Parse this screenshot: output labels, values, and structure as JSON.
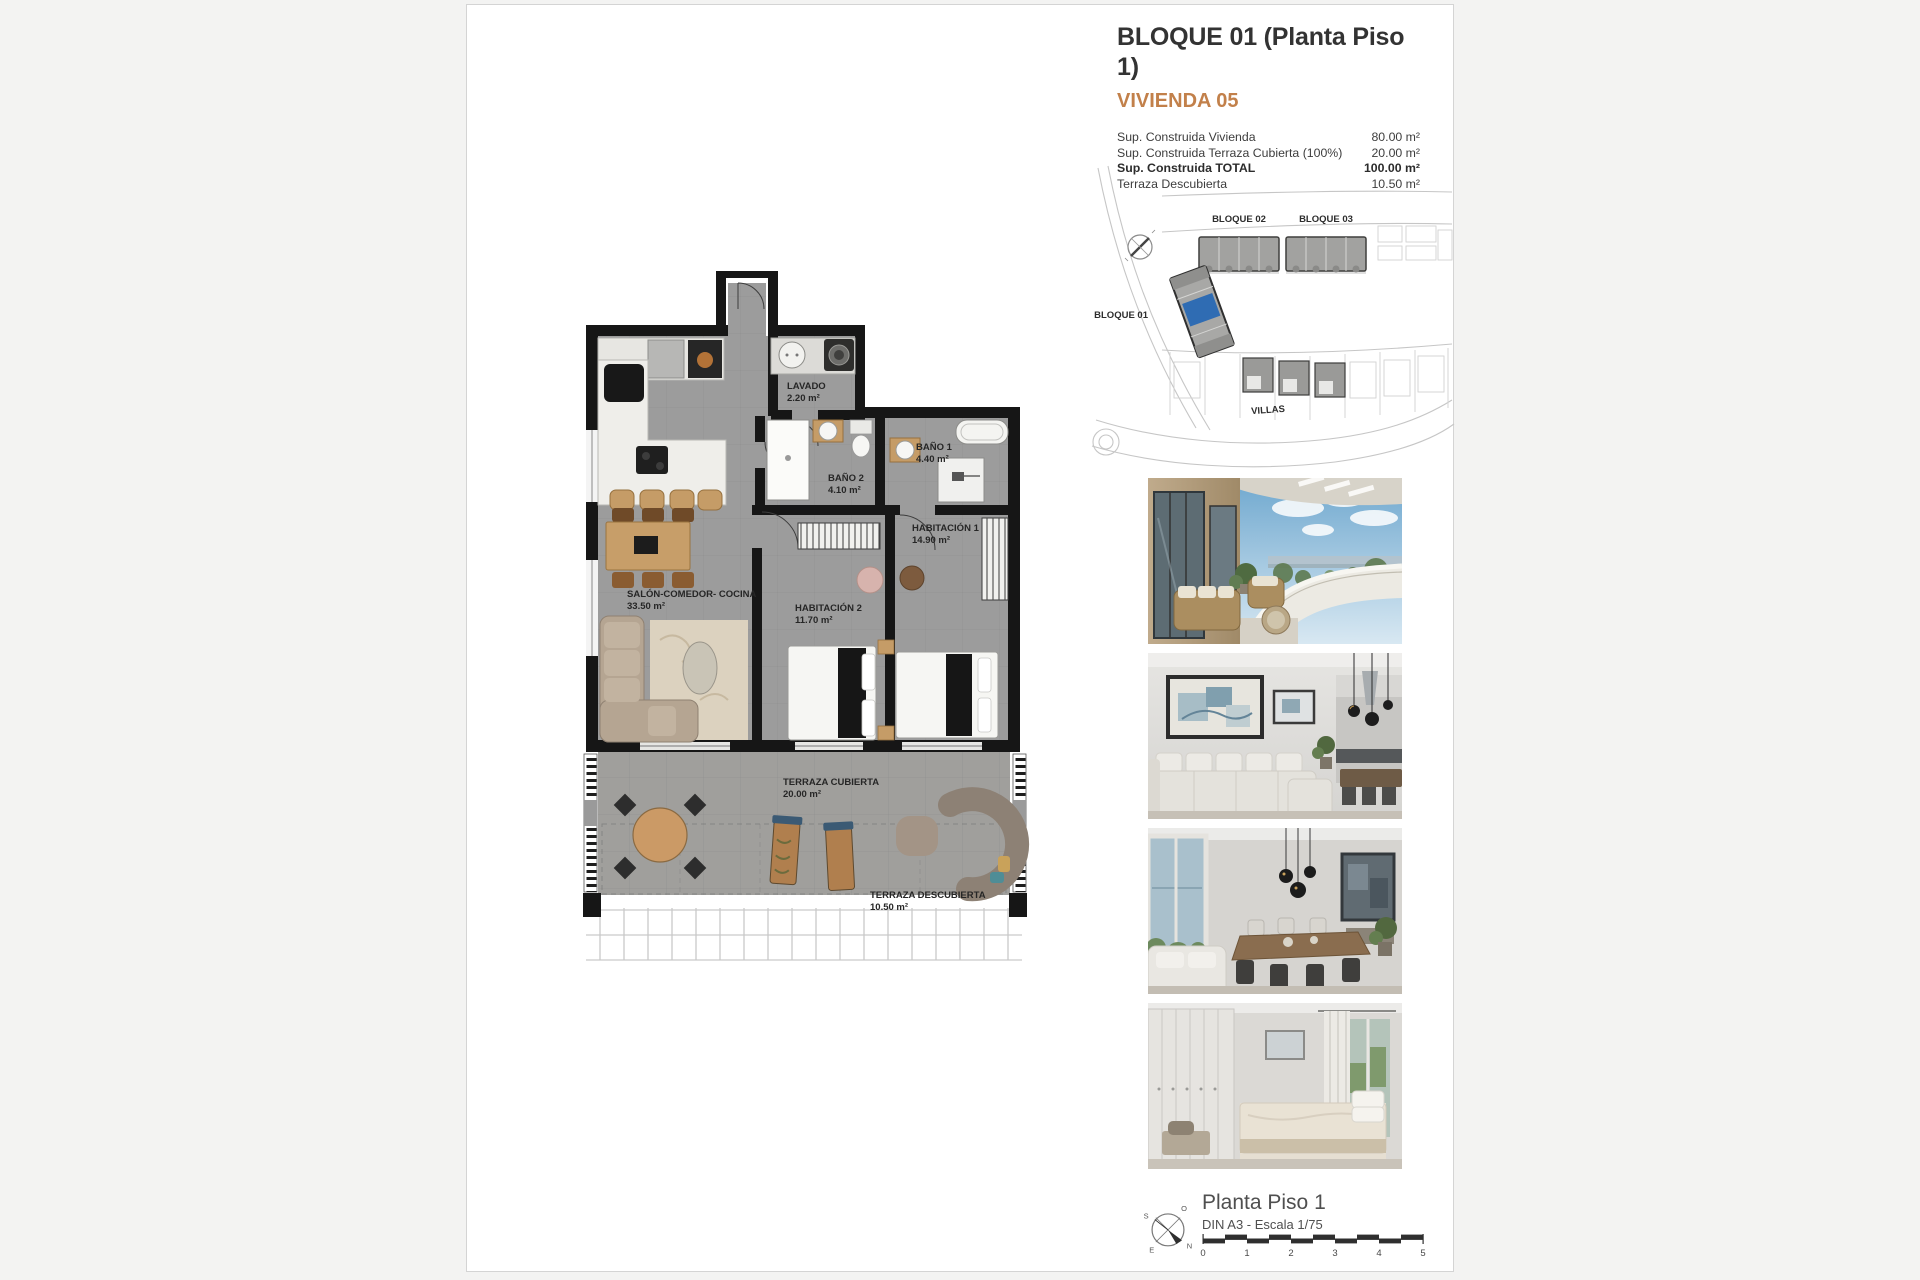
{
  "header": {
    "title": "BLOQUE 01  (Planta Piso 1)",
    "subtitle": "VIVIENDA 05",
    "accent_color": "#c2804a",
    "areas": [
      {
        "label": "Sup. Construida Vivienda",
        "value": "80.00 m²"
      },
      {
        "label": "Sup. Construida Terraza Cubierta (100%)",
        "value": "20.00 m²"
      },
      {
        "label": "Sup. Construida TOTAL",
        "value": "100.00 m²"
      },
      {
        "label": "Terraza Descubierta",
        "value": "10.50 m²"
      }
    ]
  },
  "site_plan": {
    "labels": {
      "bloque01": "BLOQUE 01",
      "bloque02": "BLOQUE 02",
      "bloque03": "BLOQUE 03",
      "villas": "VILLAS"
    },
    "highlight_color": "#2f6cb3"
  },
  "floor_plan": {
    "rooms": {
      "lavado": {
        "name": "LAVADO",
        "area": "2.20 m²"
      },
      "bano2": {
        "name": "BAÑO 2",
        "area": "4.10 m²"
      },
      "bano1": {
        "name": "BAÑO 1",
        "area": "4.40 m²"
      },
      "habitacion1": {
        "name": "HABITACIÓN 1",
        "area": "14.90 m²"
      },
      "habitacion2": {
        "name": "HABITACIÓN 2",
        "area": "11.70 m²"
      },
      "salon": {
        "name": "SALÓN-COMEDOR- COCINA",
        "area": "33.50 m²"
      },
      "terraza_cubierta": {
        "name": "TERRAZA CUBIERTA",
        "area": "20.00 m²"
      },
      "terraza_descubierta": {
        "name": "TERRAZA DESCUBIERTA",
        "area": "10.50 m²"
      }
    }
  },
  "footer": {
    "drawing_title": "Planta Piso 1",
    "drawing_info": "DIN A3 - Escala 1/75",
    "scale_ticks": [
      "0",
      "1",
      "2",
      "3",
      "4",
      "5"
    ],
    "compass": {
      "n": "N",
      "s": "S",
      "e": "E",
      "o": "O"
    }
  }
}
